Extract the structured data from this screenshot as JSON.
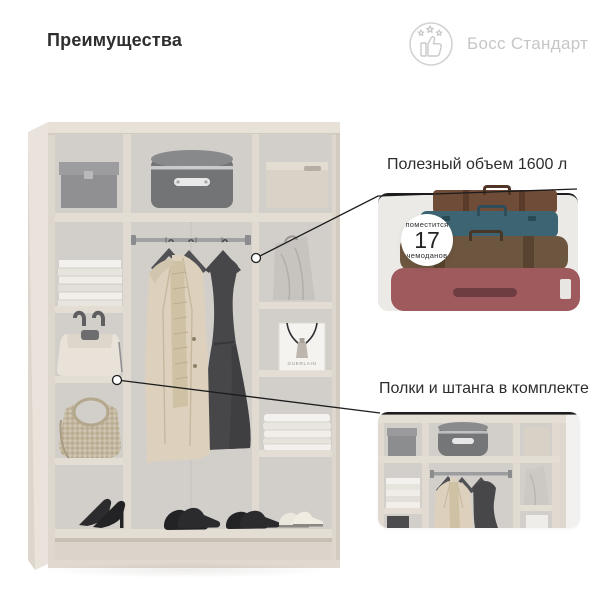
{
  "page": {
    "title": "Преимущества",
    "background": "#ffffff"
  },
  "logo": {
    "label": "Босс Стандарт",
    "icon": "thumbs-up-stars-icon",
    "color": "#c6c6c6"
  },
  "callout_volume": {
    "title": "Полезный объем 1600 л",
    "badge": {
      "line_top": "поместится",
      "number": "17",
      "line_bottom": "чемоданов"
    },
    "image": "suitcase-stack-photo",
    "suitcase_colors": {
      "top_brown": "#6f4c37",
      "teal": "#3c6472",
      "leather_brown": "#6d5640",
      "maroon": "#9e5a5d"
    }
  },
  "callout_included": {
    "title": "Полки и штанга в комплекте",
    "image": "wardrobe-shelves-closeup-photo"
  },
  "wardrobe": {
    "bag_label": "GUERLAIN",
    "colors": {
      "frame": "#ded7ce",
      "interior": "#d2cfca",
      "card_bg": "#eceae7"
    }
  }
}
